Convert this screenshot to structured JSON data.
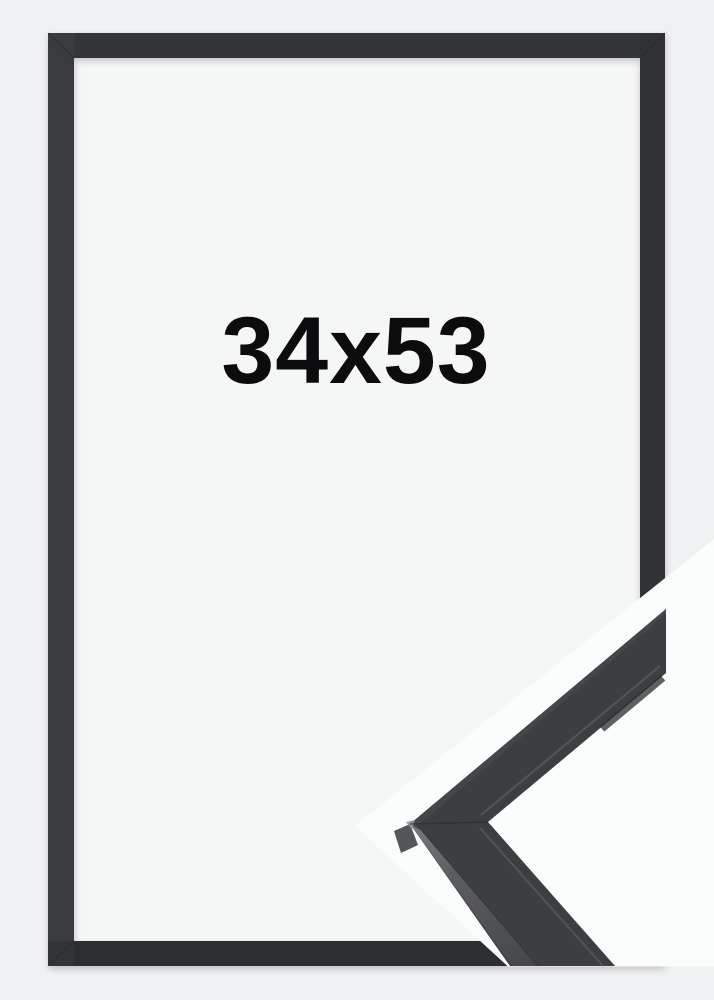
{
  "product_image": {
    "size_label": "34x53",
    "colors": {
      "background": "#f0f1f2",
      "opening": "#f5f6f6",
      "cutout": "#fbfcfc",
      "frame": "#343538",
      "frame_bottom_shade": "#000000",
      "label": "#0c0c0e",
      "sample_front": "#3d3e41",
      "sample_side_light": "#77787b",
      "sample_side_dark": "#46474a",
      "sample_edge_face": "#55565a",
      "sample_top_strip": "#45464a"
    }
  }
}
